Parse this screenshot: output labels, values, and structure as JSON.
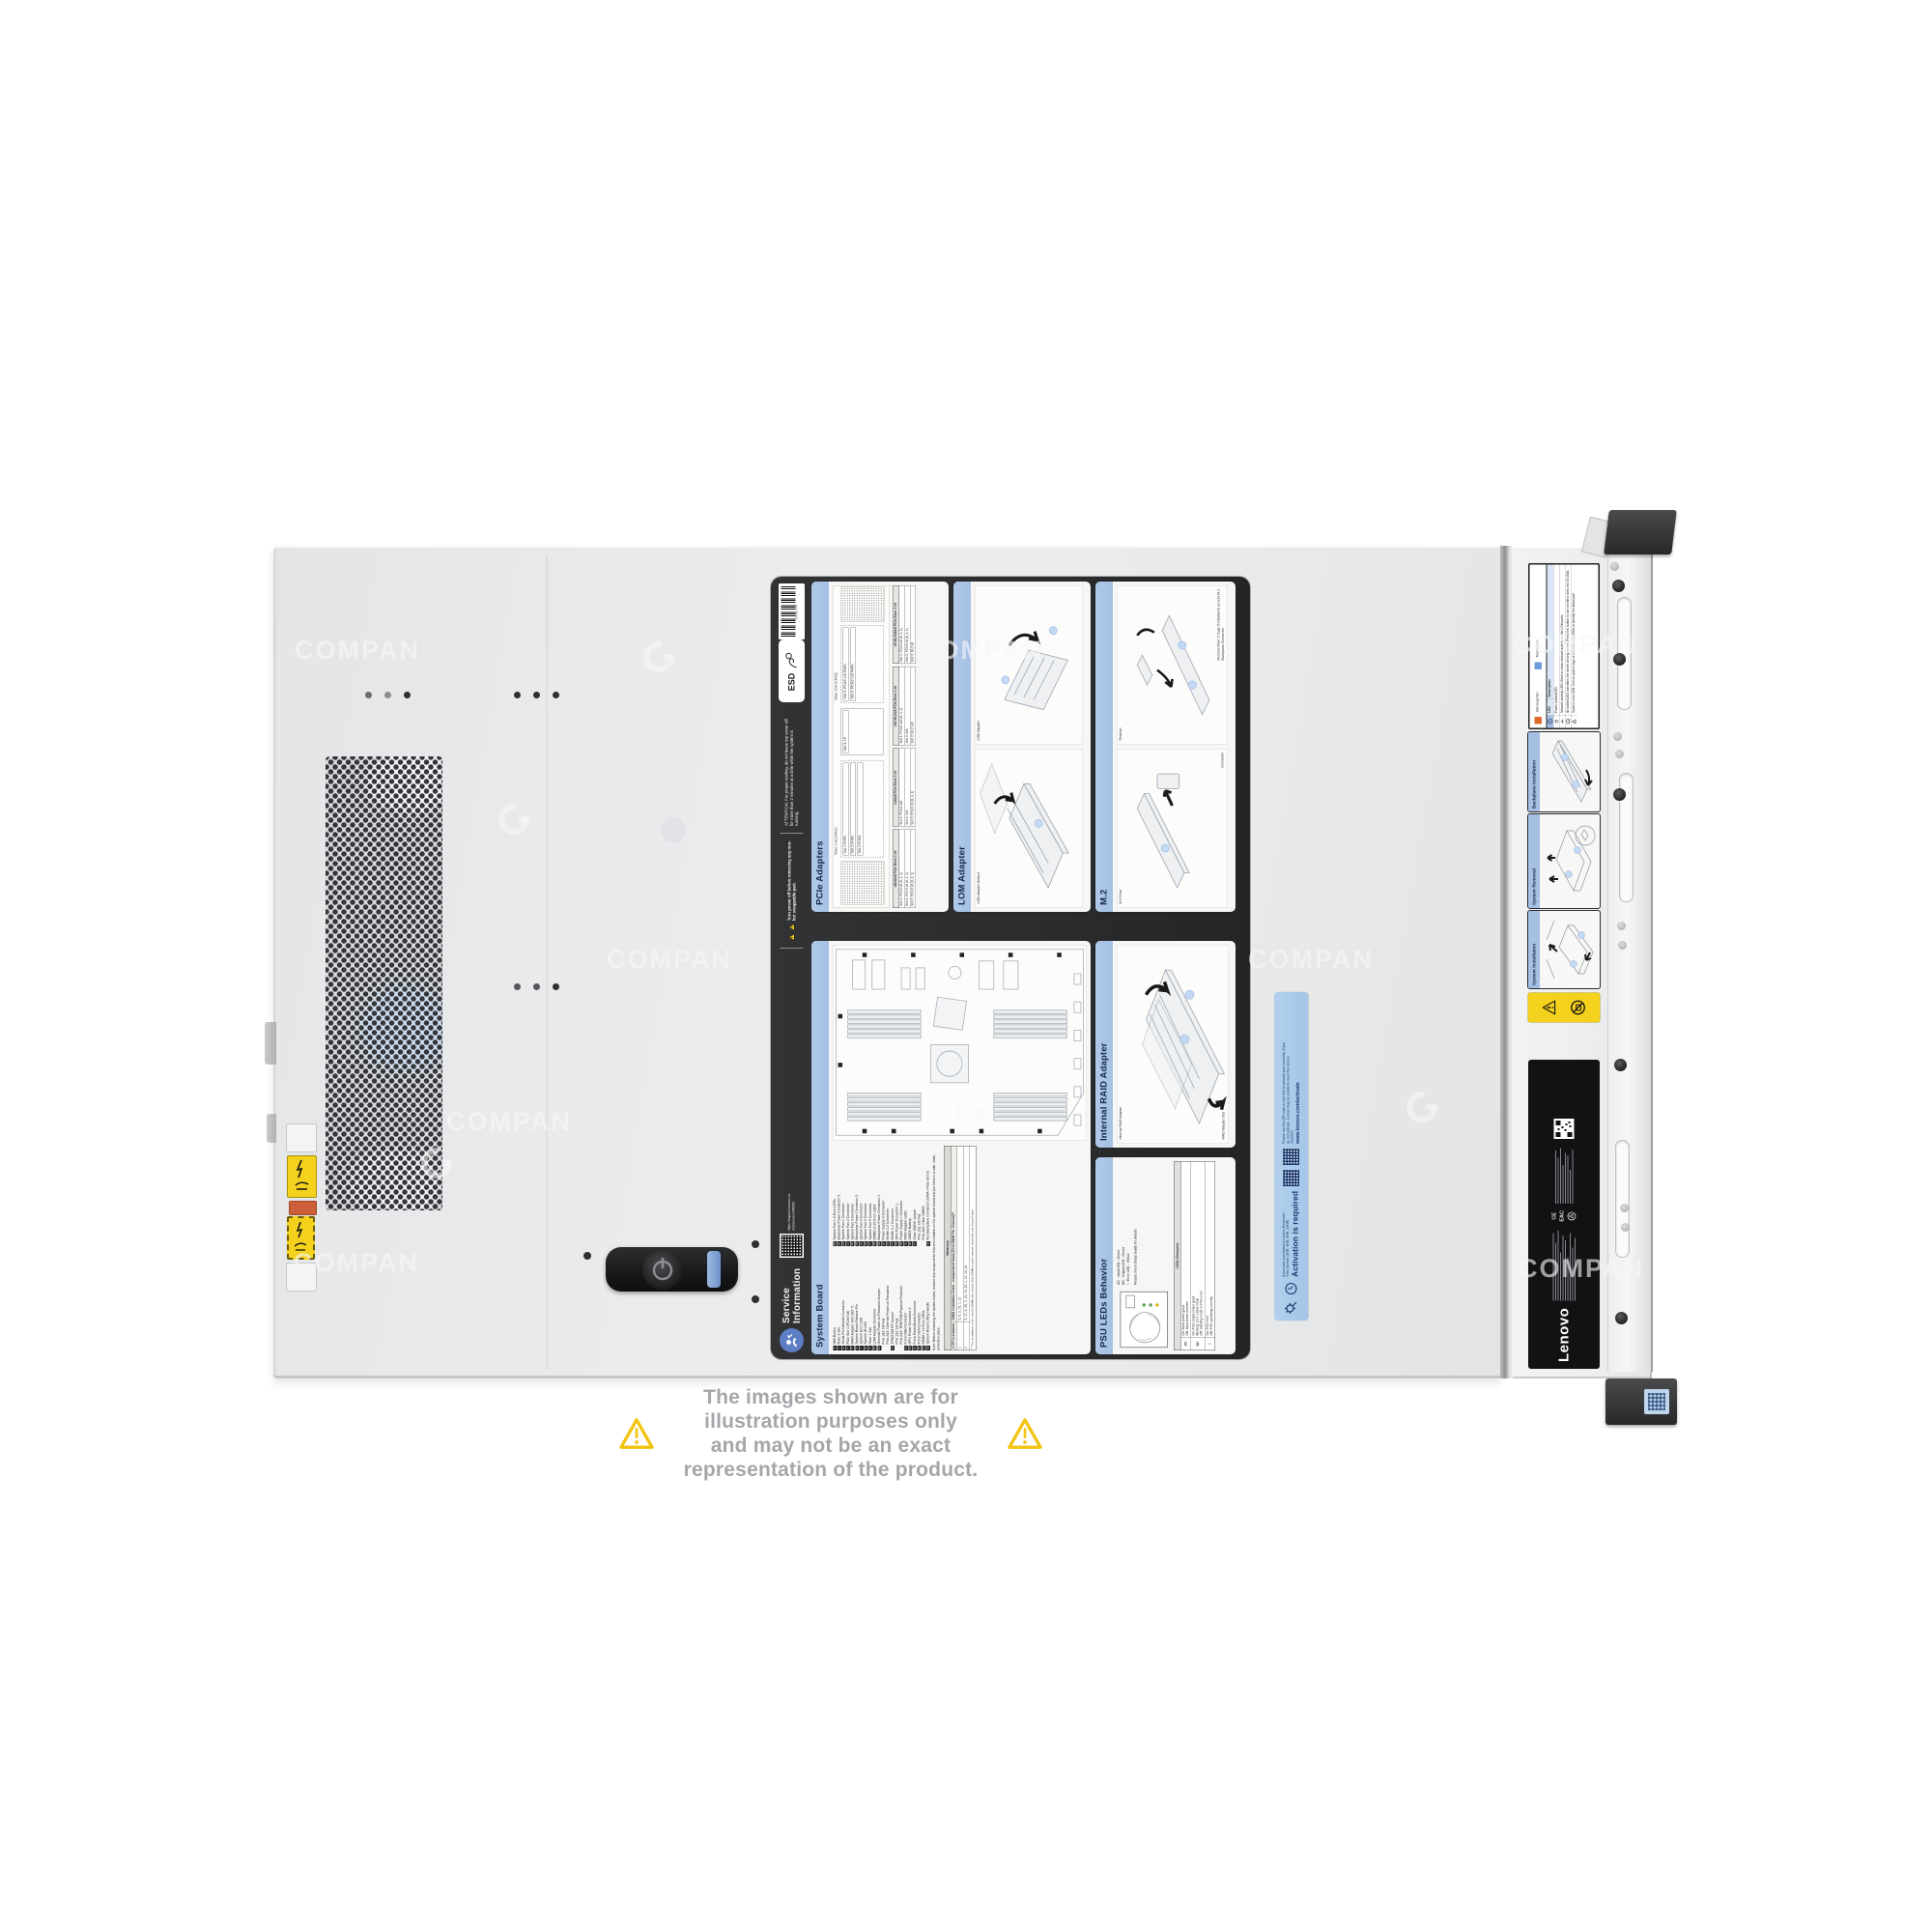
{
  "page": {
    "watermark": "COMPAN",
    "disclaimer_line1": "The images shown are for illustration purposes only",
    "disclaimer_line2": "and may not be an exact representation of the product."
  },
  "service_label": {
    "header": {
      "title_line1": "Service",
      "title_line2": "Information",
      "qr_caption": "https://support.lenovo.com/p/servers/SR650",
      "power_warning": "Turn power off before removing any non-hot swappable part.",
      "attention": "ATTENTION:  For proper cooling, do not leave top cover off for more than 2 minutes at a time while the system is running.",
      "esd": "ESD",
      "barcode_number": "SR650 SVC"
    },
    "pcie": {
      "title": "PCIe Adapters",
      "riser1_label": "Riser 1 kit (CPU1)",
      "riser2_label": "Riser 2 kit (CPU2)",
      "slots": [
        "Slot 1 FH/FL",
        "Slot 2 FH/FL",
        "Slot 3 FH/HL",
        "Slot 4: LP",
        "Slot 5: PCIe3 x16 FH/FL",
        "Slot 6: PCIe3 x16 FH/FL"
      ],
      "tables": [
        {
          "title": "x8/x8/x8 PCIe Riser 1 kit",
          "rows": [
            "Slot 1: PCIe3 x8 (8, 4, 1)",
            "Slot 2: PCIe3 x8 (8, 4, 1)",
            "Slot 3: PCIe3 x8 (8, 4, 1)"
          ]
        },
        {
          "title": "x16/x8 PCIe Riser 1 kit",
          "rows": [
            "Slot 1: PCIe3 x16",
            "Slot 2: N/A",
            "Slot 3: PCIe3 x8 (8, 4, 1)"
          ]
        },
        {
          "title": "x16 ML2/x8 PCIe Riser 1 kit",
          "rows": [
            "Slot 1: PCIe3 x16 (8, 4, 1)",
            "Slot 2: N/A",
            "Slot 3: ML2 x16"
          ]
        },
        {
          "title": "x8 ML2/x8/x8 PCIe Riser 1 kit",
          "rows": [
            "Slot 1: PCIe3 x8 (8, 4, 1)",
            "Slot 2: PCIe3 x8 (8, 4, 1)",
            "Slot 3: ML2 x8"
          ]
        }
      ]
    },
    "lom": {
      "title": "LOM Adapter",
      "label1": "LOM Adapter Airduct",
      "label2": "LOM Adapter"
    },
    "m2": {
      "title": "M.2",
      "label_drive": "M.2 Drive",
      "label_retainer": "Retainer",
      "label_connector": "Connector",
      "note": "Remove Riser 2 Cage if installed to access M.2 Backplane Connector"
    },
    "raid": {
      "title": "Internal RAID Adapter",
      "label1": "Internal RAID Adapter",
      "label2": "RAID Adapter Slot"
    },
    "psu": {
      "title": "PSU LEDs Behavior",
      "led1": "AC :  Input LED - Green",
      "led2": "DC :  Output LED - Green",
      "led3": "!  :  Error LED - Yellow",
      "note": "Please check Setup Guide for details.",
      "table_title": "LEDs Behavior",
      "rows": [
        [
          "AC",
          "On: Input power good\nOff: Input power problem"
        ],
        [
          "DC",
          "On: PSU output power good\nBlinking: Zero output mode\nOff: Standby mode or PSU error"
        ],
        [
          "!",
          "On: PSU error\nOff: PSU operating correctly"
        ]
      ]
    },
    "system_board": {
      "title": "System Board",
      "callouts_left": [
        {
          "n": "1",
          "t": "NMI Button"
        },
        {
          "n": "2",
          "t": "Riser 2 Slot"
        },
        {
          "n": "3",
          "t": "Serial-Port-Module Connector"
        },
        {
          "n": "4",
          "t": "PCIe Slot 4 (PCIe3 x8)"
        },
        {
          "n": "5",
          "t": "RAID Adapter Slot (Slot 7)"
        },
        {
          "n": "6",
          "t": "System Board Release Pin"
        },
        {
          "n": "7",
          "t": "System Error LED"
        },
        {
          "n": "8",
          "t": "System ID LED"
        },
        {
          "n": "9",
          "t": "Riser 1 Slot"
        },
        {
          "n": "10",
          "t": "LOM Adapter Connector"
        },
        {
          "n": "11",
          "t": "Override Power-on Password Jumper"
        },
        {
          "n": "",
          "t": "Pins 1&2: Normal"
        },
        {
          "n": "",
          "t": "Pins 2&3: Override Power-on Password"
        },
        {
          "n": "12",
          "t": "TPM/TCM PP Jumper"
        },
        {
          "n": "",
          "t": "Pins 1&2: Normal"
        },
        {
          "n": "",
          "t": "Pins 2&3: TPM/TCM Physical Presence"
        },
        {
          "n": "13",
          "t": "Front USB Connector"
        },
        {
          "n": "14",
          "t": "GPU Power Connector 2"
        },
        {
          "n": "15",
          "t": "Front-Panel-Board Connector"
        },
        {
          "n": "16",
          "t": "Front VGA Connector"
        },
        {
          "n": "17",
          "t": "DIMM 1-12 Error LEDs"
        },
        {
          "n": "18",
          "t": "System Board Lifting Handle"
        }
      ],
      "callouts_right": [
        {
          "n": "19",
          "t": "System Fan 1-6 Error LEDs"
        },
        {
          "n": "20",
          "t": "Backplane Power Connector 3"
        },
        {
          "n": "21",
          "t": "System Fan 1 Connector"
        },
        {
          "n": "22",
          "t": "System Fan 2 Connector"
        },
        {
          "n": "23",
          "t": "System Fan 3 Connector"
        },
        {
          "n": "24",
          "t": "Backplane Power Connector 2"
        },
        {
          "n": "25",
          "t": "System Fan 4 Connector"
        },
        {
          "n": "26",
          "t": "System Fan 5 Connector"
        },
        {
          "n": "27",
          "t": "System Fan 6 Connector"
        },
        {
          "n": "28",
          "t": "DIMM 13-24 Error LEDs"
        },
        {
          "n": "29",
          "t": "Backplane Power Connector 1"
        },
        {
          "n": "30",
          "t": "Power Supply 2 Connector"
        },
        {
          "n": "31",
          "t": "NVMe 2-3 Connector"
        },
        {
          "n": "32",
          "t": "NVMe 0-1 Connector"
        },
        {
          "n": "33",
          "t": "GPU Power Connector 1"
        },
        {
          "n": "34",
          "t": "Power Supply 1 Connector"
        },
        {
          "n": "35",
          "t": "RAID Adapter LEDs"
        },
        {
          "n": "36",
          "t": "CMOS Battery"
        },
        {
          "n": "37",
          "t": "Clear CMOS Jumper"
        },
        {
          "n": "",
          "t": "Pins 1&2: Normal"
        },
        {
          "n": "",
          "t": "Pins 2&3: Clear CMOS"
        },
        {
          "n": "38",
          "t": "M.2 Backplane Connector (SATA / PCIe Slot 8)"
        }
      ],
      "note": "Note: Before removing the system board, remove any components that are installed on the system board and put them in a safe, static-protective place.",
      "memory": {
        "title": "Memory",
        "col1": "# CPUs Installed",
        "col2": "DIMM Installation Order - Independent Mode (First DIMM Per Channel)**",
        "rows": [
          [
            "1",
            "5, 8, 3, 10, 1, 12"
          ],
          [
            "2",
            "5, 17, 8, 20, 3, 15, 10, 22, 1, 13, 12, 24"
          ]
        ],
        "footnote": "** For installation of the next 6 DIMMs per socket (2nd DIMM in each memory channel), see Setup Guide."
      }
    }
  },
  "activation_sticker": {
    "small_text": "If you have purchased a Lenovo Response Time Service (2HR, 4HR, 8HR, 24HR)",
    "title": "Activation is required",
    "body_text": "Please use the QR code or web link to activate your warranty. If you do not activate, Lenovo may be unable to meet the service objective",
    "url": "www.lenovo.com/activate"
  },
  "front_panel": {
    "brand": "Lenovo",
    "certs": [
      "CE",
      "EAC"
    ],
    "legend": {
      "hot_swap": "Hot swap fan",
      "touch_point": "Touch point",
      "col_led": "LED",
      "col_desc": "Description",
      "rows": [
        "Power button/LED",
        "Network Activity LED: Blink to show network activity on the LOM ports",
        "ID button/LED: Identifies the server among others. Press the button to turn on/off or blink the ID LEDs",
        "System error LED: Check system logs or internal error LEDs to identify the failed part"
      ]
    },
    "cards": [
      "System Installation",
      "System Removal",
      "Backplane Installation"
    ]
  }
}
